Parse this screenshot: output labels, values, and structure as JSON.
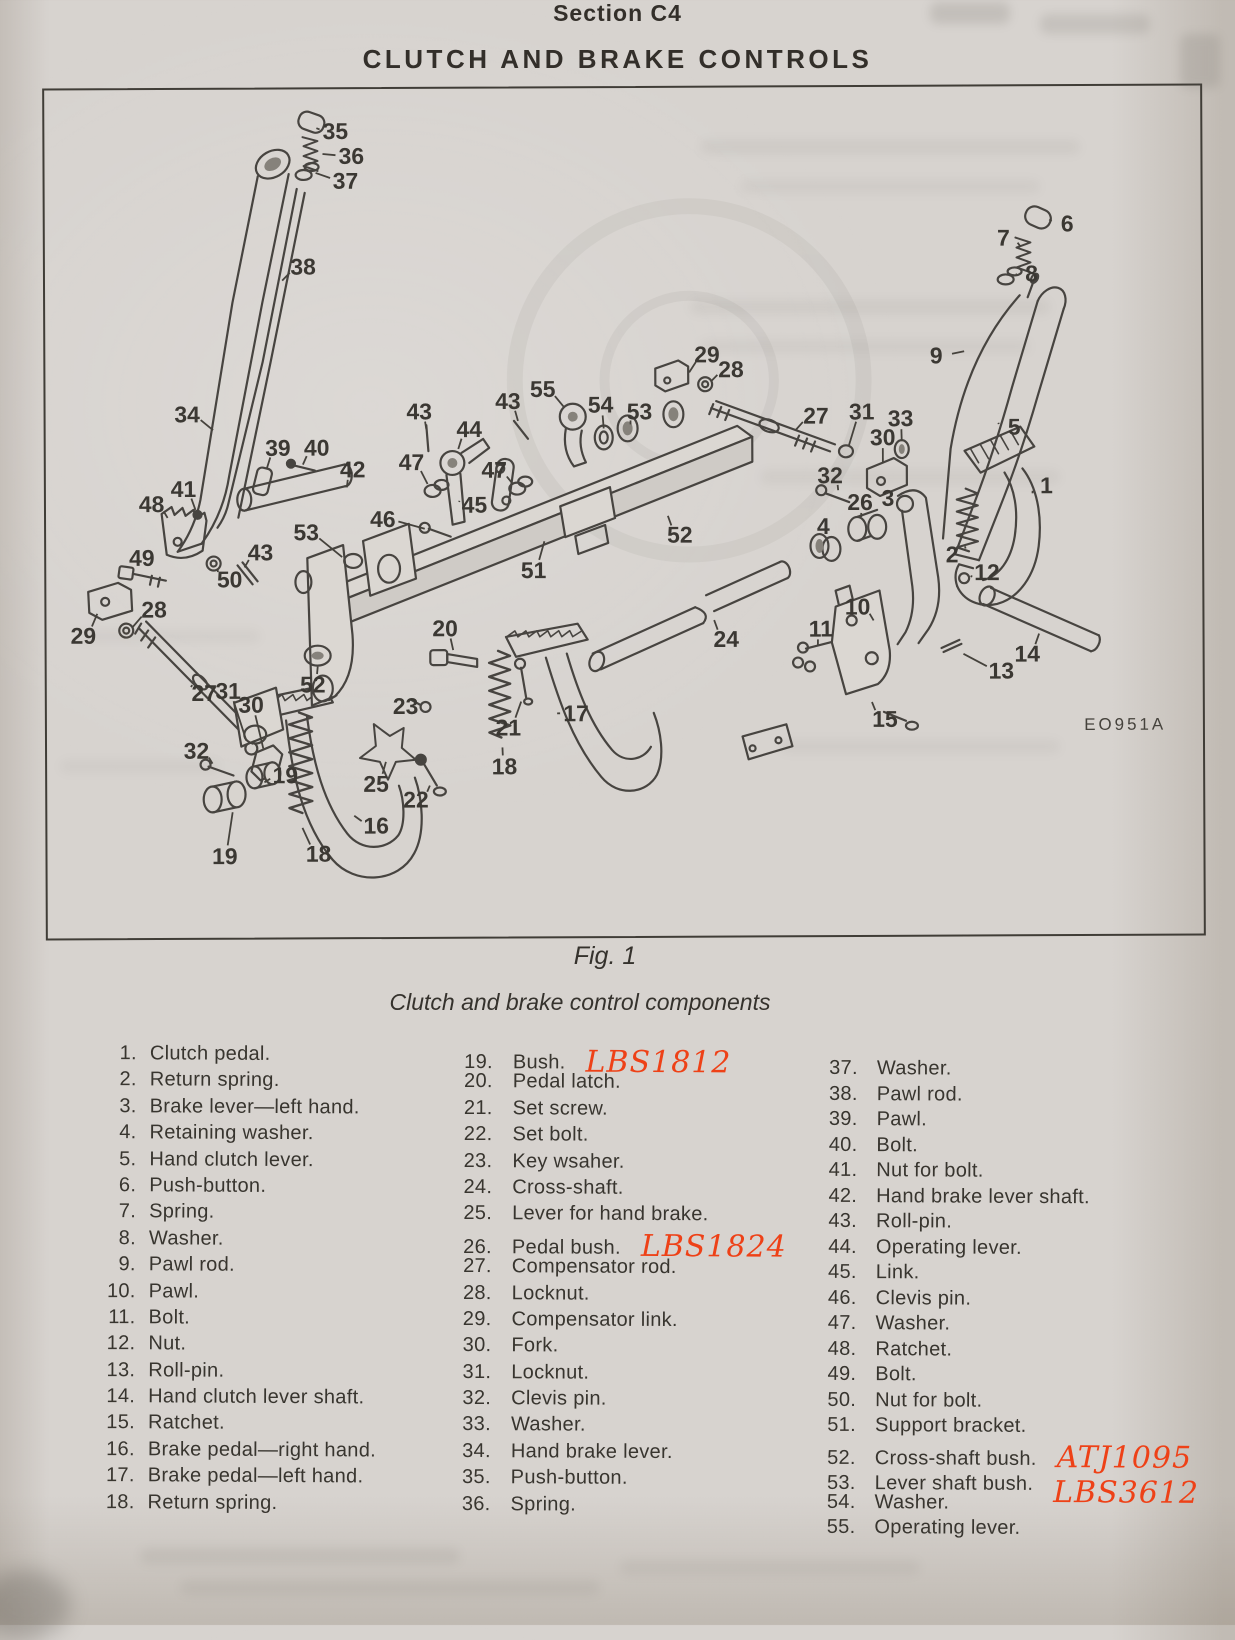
{
  "header": {
    "section": "Section C4",
    "title": "CLUTCH AND BRAKE CONTROLS"
  },
  "figure": {
    "label": "Fig. 1",
    "caption": "Clutch and brake control components",
    "plate_code": "EO951A"
  },
  "colors": {
    "paper": "#d7d3cf",
    "ink": "#3a3732",
    "handwritten_ink": "#ee4117"
  },
  "handwritten_annotations": [
    "LBS1812",
    "LBS1824",
    "ATJ1095",
    "LBS3612"
  ],
  "parts_list": {
    "columns": [
      {
        "items": [
          {
            "num": "1.",
            "label": "Clutch pedal."
          },
          {
            "num": "2.",
            "label": "Return spring."
          },
          {
            "num": "3.",
            "label": "Brake lever—left hand."
          },
          {
            "num": "4.",
            "label": "Retaining washer."
          },
          {
            "num": "5.",
            "label": "Hand clutch lever."
          },
          {
            "num": "6.",
            "label": "Push-button."
          },
          {
            "num": "7.",
            "label": "Spring."
          },
          {
            "num": "8.",
            "label": "Washer."
          },
          {
            "num": "9.",
            "label": "Pawl rod."
          },
          {
            "num": "10.",
            "label": "Pawl."
          },
          {
            "num": "11.",
            "label": "Bolt."
          },
          {
            "num": "12.",
            "label": "Nut."
          },
          {
            "num": "13.",
            "label": "Roll-pin."
          },
          {
            "num": "14.",
            "label": "Hand clutch lever shaft."
          },
          {
            "num": "15.",
            "label": "Ratchet."
          },
          {
            "num": "16.",
            "label": "Brake pedal—right hand."
          },
          {
            "num": "17.",
            "label": "Brake pedal—left hand."
          },
          {
            "num": "18.",
            "label": "Return spring."
          }
        ]
      },
      {
        "items": [
          {
            "num": "19.",
            "label": "Bush.",
            "annot": "LBS1812",
            "annot_dy": 0
          },
          {
            "num": "20.",
            "label": "Pedal latch."
          },
          {
            "num": "21.",
            "label": "Set screw."
          },
          {
            "num": "22.",
            "label": "Set bolt."
          },
          {
            "num": "23.",
            "label": "Key wsaher."
          },
          {
            "num": "24.",
            "label": "Cross-shaft."
          },
          {
            "num": "25.",
            "label": "Lever for hand brake."
          },
          {
            "num": "26.",
            "label": "Pedal bush.",
            "annot": "LBS1824",
            "annot_dy": 2
          },
          {
            "num": "27.",
            "label": "Compensator rod."
          },
          {
            "num": "28.",
            "label": "Locknut."
          },
          {
            "num": "29.",
            "label": "Compensator link."
          },
          {
            "num": "30.",
            "label": "Fork."
          },
          {
            "num": "31.",
            "label": "Locknut."
          },
          {
            "num": "32.",
            "label": "Clevis pin."
          },
          {
            "num": "33.",
            "label": "Washer."
          },
          {
            "num": "34.",
            "label": "Hand brake lever."
          },
          {
            "num": "35.",
            "label": "Push-button."
          },
          {
            "num": "36.",
            "label": "Spring."
          }
        ]
      },
      {
        "items": [
          {
            "num": "37.",
            "label": "Washer."
          },
          {
            "num": "38.",
            "label": "Pawl rod."
          },
          {
            "num": "39.",
            "label": "Pawl."
          },
          {
            "num": "40.",
            "label": "Bolt."
          },
          {
            "num": "41.",
            "label": "Nut for bolt."
          },
          {
            "num": "42.",
            "label": "Hand brake lever shaft."
          },
          {
            "num": "43.",
            "label": "Roll-pin."
          },
          {
            "num": "44.",
            "label": "Operating lever."
          },
          {
            "num": "45.",
            "label": "Link."
          },
          {
            "num": "46.",
            "label": "Clevis pin."
          },
          {
            "num": "47.",
            "label": "Washer."
          },
          {
            "num": "48.",
            "label": "Ratchet."
          },
          {
            "num": "49.",
            "label": "Bolt."
          },
          {
            "num": "50.",
            "label": "Nut for bolt."
          },
          {
            "num": "51.",
            "label": "Support bracket."
          },
          {
            "num": "52.",
            "label": "Cross-shaft bush.",
            "annot": "ATJ1095",
            "annot_dy": 2
          },
          {
            "num": "53.",
            "label": "Lever shaft bush.",
            "annot": "LBS3612",
            "annot_dy": 12
          },
          {
            "num": "54.",
            "label": "Washer."
          },
          {
            "num": "55.",
            "label": "Operating lever."
          }
        ]
      }
    ]
  },
  "diagram": {
    "callouts": [
      {
        "n": "35",
        "x": 336,
        "y": 128,
        "tx": 317,
        "ty": 125
      },
      {
        "n": "36",
        "x": 352,
        "y": 153,
        "tx": 323,
        "ty": 151
      },
      {
        "n": "37",
        "x": 346,
        "y": 178,
        "tx": 316,
        "ty": 170
      },
      {
        "n": "38",
        "x": 303,
        "y": 264,
        "tx": 282,
        "ty": 278
      },
      {
        "n": "34",
        "x": 186,
        "y": 412,
        "tx": 212,
        "ty": 428
      },
      {
        "n": "39",
        "x": 277,
        "y": 446,
        "tx": 266,
        "ty": 466
      },
      {
        "n": "40",
        "x": 316,
        "y": 446,
        "tx": 302,
        "ty": 463
      },
      {
        "n": "41",
        "x": 182,
        "y": 487,
        "tx": 194,
        "ty": 508
      },
      {
        "n": "48",
        "x": 150,
        "y": 502,
        "tx": 166,
        "ty": 516
      },
      {
        "n": "49",
        "x": 140,
        "y": 556,
        "tx": 134,
        "ty": 568
      },
      {
        "n": "50",
        "x": 228,
        "y": 578,
        "tx": 216,
        "ty": 567
      },
      {
        "n": "43",
        "x": 259,
        "y": 551,
        "tx": 243,
        "ty": 566
      },
      {
        "n": "53",
        "x": 305,
        "y": 531,
        "tx": 341,
        "ty": 556
      },
      {
        "n": "29",
        "x": 81,
        "y": 634,
        "tx": 95,
        "ty": 612
      },
      {
        "n": "28",
        "x": 152,
        "y": 608,
        "tx": 130,
        "ty": 626
      },
      {
        "n": "27",
        "x": 202,
        "y": 692,
        "tx": 190,
        "ty": 684
      },
      {
        "n": "31",
        "x": 226,
        "y": 690,
        "tx": 244,
        "ty": 740
      },
      {
        "n": "30",
        "x": 249,
        "y": 704,
        "tx": 261,
        "ty": 748
      },
      {
        "n": "52",
        "x": 311,
        "y": 684,
        "tx": 316,
        "ty": 666
      },
      {
        "n": "32",
        "x": 194,
        "y": 750,
        "tx": 210,
        "ty": 763
      },
      {
        "n": "19",
        "x": 283,
        "y": 775,
        "tx": 262,
        "ty": 782
      },
      {
        "n": "19",
        "x": 222,
        "y": 856,
        "tx": 230,
        "ty": 812
      },
      {
        "n": "25",
        "x": 374,
        "y": 784,
        "tx": 384,
        "ty": 762
      },
      {
        "n": "22",
        "x": 414,
        "y": 800,
        "tx": 428,
        "ty": 786
      },
      {
        "n": "16",
        "x": 374,
        "y": 826,
        "tx": 352,
        "ty": 816
      },
      {
        "n": "18",
        "x": 316,
        "y": 854,
        "tx": 300,
        "ty": 828
      },
      {
        "n": "18",
        "x": 503,
        "y": 767,
        "tx": 501,
        "ty": 748
      },
      {
        "n": "21",
        "x": 507,
        "y": 728,
        "tx": 520,
        "ty": 702
      },
      {
        "n": "17",
        "x": 575,
        "y": 714,
        "tx": 556,
        "ty": 714
      },
      {
        "n": "23",
        "x": 404,
        "y": 706,
        "tx": 418,
        "ty": 707
      },
      {
        "n": "20",
        "x": 444,
        "y": 628,
        "tx": 452,
        "ty": 650
      },
      {
        "n": "51",
        "x": 533,
        "y": 570,
        "tx": 544,
        "ty": 541
      },
      {
        "n": "24",
        "x": 726,
        "y": 640,
        "tx": 714,
        "ty": 621
      },
      {
        "n": "4",
        "x": 824,
        "y": 527,
        "tx": 821,
        "ty": 539
      },
      {
        "n": "52",
        "x": 680,
        "y": 535,
        "tx": 668,
        "ty": 516
      },
      {
        "n": "46",
        "x": 382,
        "y": 518,
        "tx": 424,
        "ty": 528
      },
      {
        "n": "45",
        "x": 474,
        "y": 504,
        "tx": 459,
        "ty": 500
      },
      {
        "n": "47",
        "x": 411,
        "y": 461,
        "tx": 427,
        "ty": 483
      },
      {
        "n": "47",
        "x": 494,
        "y": 469,
        "tx": 513,
        "ty": 484
      },
      {
        "n": "44",
        "x": 469,
        "y": 428,
        "tx": 458,
        "ty": 448
      },
      {
        "n": "43",
        "x": 419,
        "y": 410,
        "tx": 426,
        "ty": 428
      },
      {
        "n": "43",
        "x": 508,
        "y": 400,
        "tx": 518,
        "ty": 420
      },
      {
        "n": "55",
        "x": 543,
        "y": 388,
        "tx": 564,
        "ty": 406
      },
      {
        "n": "54",
        "x": 601,
        "y": 404,
        "tx": 604,
        "ty": 428
      },
      {
        "n": "53",
        "x": 640,
        "y": 411,
        "tx": 631,
        "ty": 424
      },
      {
        "n": "42",
        "x": 352,
        "y": 468,
        "tx": 346,
        "ty": 486
      },
      {
        "n": "29",
        "x": 708,
        "y": 354,
        "tx": 690,
        "ty": 372
      },
      {
        "n": "28",
        "x": 732,
        "y": 369,
        "tx": 712,
        "ty": 381
      },
      {
        "n": "27",
        "x": 817,
        "y": 416,
        "tx": 797,
        "ty": 430
      },
      {
        "n": "31",
        "x": 863,
        "y": 412,
        "tx": 850,
        "ty": 446
      },
      {
        "n": "33",
        "x": 902,
        "y": 419,
        "tx": 903,
        "ty": 442
      },
      {
        "n": "30",
        "x": 884,
        "y": 438,
        "tx": 884,
        "ty": 464
      },
      {
        "n": "32",
        "x": 831,
        "y": 476,
        "tx": 839,
        "ty": 491
      },
      {
        "n": "26",
        "x": 861,
        "y": 503,
        "tx": 862,
        "ty": 518
      },
      {
        "n": "3",
        "x": 889,
        "y": 499,
        "tx": 901,
        "ty": 506
      },
      {
        "n": "5",
        "x": 1016,
        "y": 428,
        "tx": 1000,
        "ty": 424
      },
      {
        "n": "9",
        "x": 938,
        "y": 356,
        "tx": 966,
        "ty": 352
      },
      {
        "n": "6",
        "x": 1070,
        "y": 224,
        "tx": 1052,
        "ty": 220
      },
      {
        "n": "7",
        "x": 1006,
        "y": 238,
        "tx": 1023,
        "ty": 247
      },
      {
        "n": "8",
        "x": 1034,
        "y": 274,
        "tx": 1019,
        "ty": 275
      },
      {
        "n": "1",
        "x": 1048,
        "y": 487,
        "tx": 1034,
        "ty": 495
      },
      {
        "n": "2",
        "x": 953,
        "y": 556,
        "tx": 966,
        "ty": 548
      },
      {
        "n": "12",
        "x": 988,
        "y": 574,
        "tx": 972,
        "ty": 579
      },
      {
        "n": "10",
        "x": 858,
        "y": 608,
        "tx": 874,
        "ty": 622
      },
      {
        "n": "11",
        "x": 821,
        "y": 630,
        "tx": 818,
        "ty": 646
      },
      {
        "n": "14",
        "x": 1028,
        "y": 656,
        "tx": 1040,
        "ty": 636
      },
      {
        "n": "13",
        "x": 1002,
        "y": 673,
        "tx": 964,
        "ty": 656
      },
      {
        "n": "15",
        "x": 885,
        "y": 721,
        "tx": 872,
        "ty": 704
      }
    ]
  }
}
